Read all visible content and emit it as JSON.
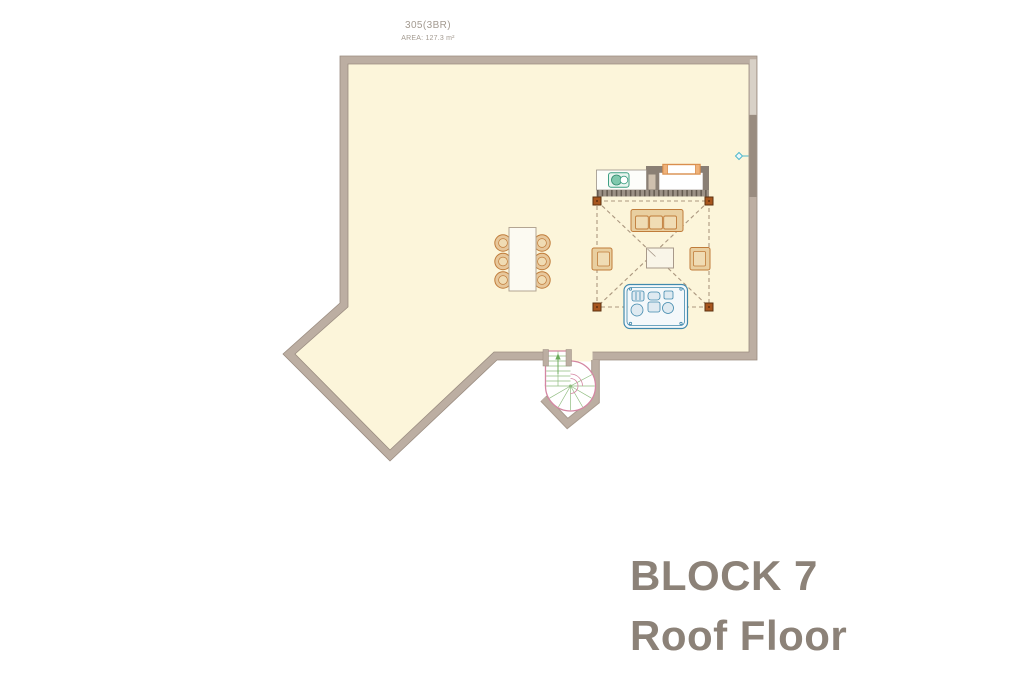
{
  "plan": {
    "unit_label": "305(3BR)",
    "area_label": "AREA: 127.3 m²"
  },
  "title": {
    "block": "BLOCK 7",
    "floor": "Roof Floor"
  },
  "colors": {
    "floor": "#fcf5da",
    "wall": "#bcaea2",
    "wall_dark_segment": "#998c80",
    "wall_light_segment": "#d8d1c7",
    "kitchen_gray": "#8a7f74",
    "furniture_outline": "#c07c3a",
    "furniture_fill": "#e9cfa0",
    "pergola_post": "#a8561e",
    "stair_pink": "#d486a2",
    "stair_tread_green": "#8fbc7f",
    "hot_tub_blue": "#4089ad",
    "sink_teal": "#3fa083",
    "tap_cyan": "#4fb8cb",
    "label_text": "#a39a90",
    "title_text": "#8c8278"
  }
}
